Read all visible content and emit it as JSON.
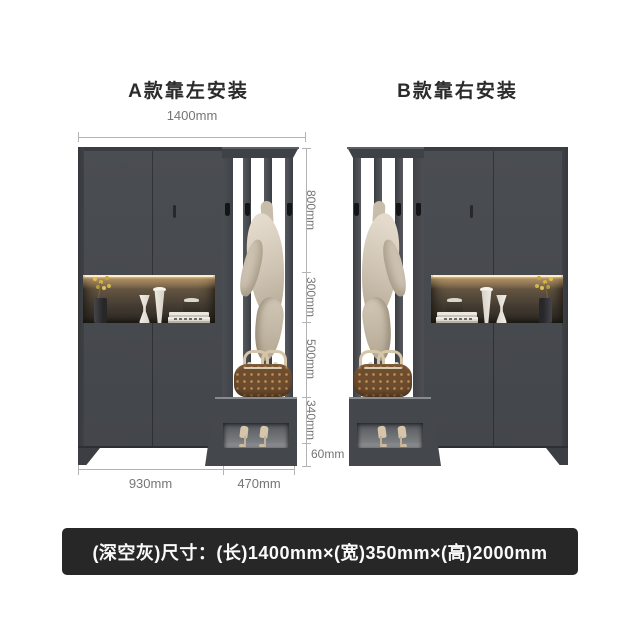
{
  "titles": {
    "variant_a": "A款靠左安装",
    "variant_b": "B款靠右安装"
  },
  "dimensions": {
    "overall_width": "1400mm",
    "upper_section_height": "800mm",
    "niche_height": "300mm",
    "open_section_height": "500mm",
    "bench_section_height": "340mm",
    "base_height": "60mm",
    "cabinet_width": "930mm",
    "rack_width": "470mm"
  },
  "footer": {
    "size_text": "(深空灰)尺寸：(长)1400mm×(宽)350mm×(高)2000mm"
  },
  "colors": {
    "cabinet_gray": "#474a4f",
    "niche_glow": "#ffe6b8",
    "coat_beige": "#cfc4b3",
    "bag_brown": "#6e4c2e",
    "footer_bg": "#272727",
    "dimension_gray": "#757575",
    "background": "#ffffff"
  }
}
